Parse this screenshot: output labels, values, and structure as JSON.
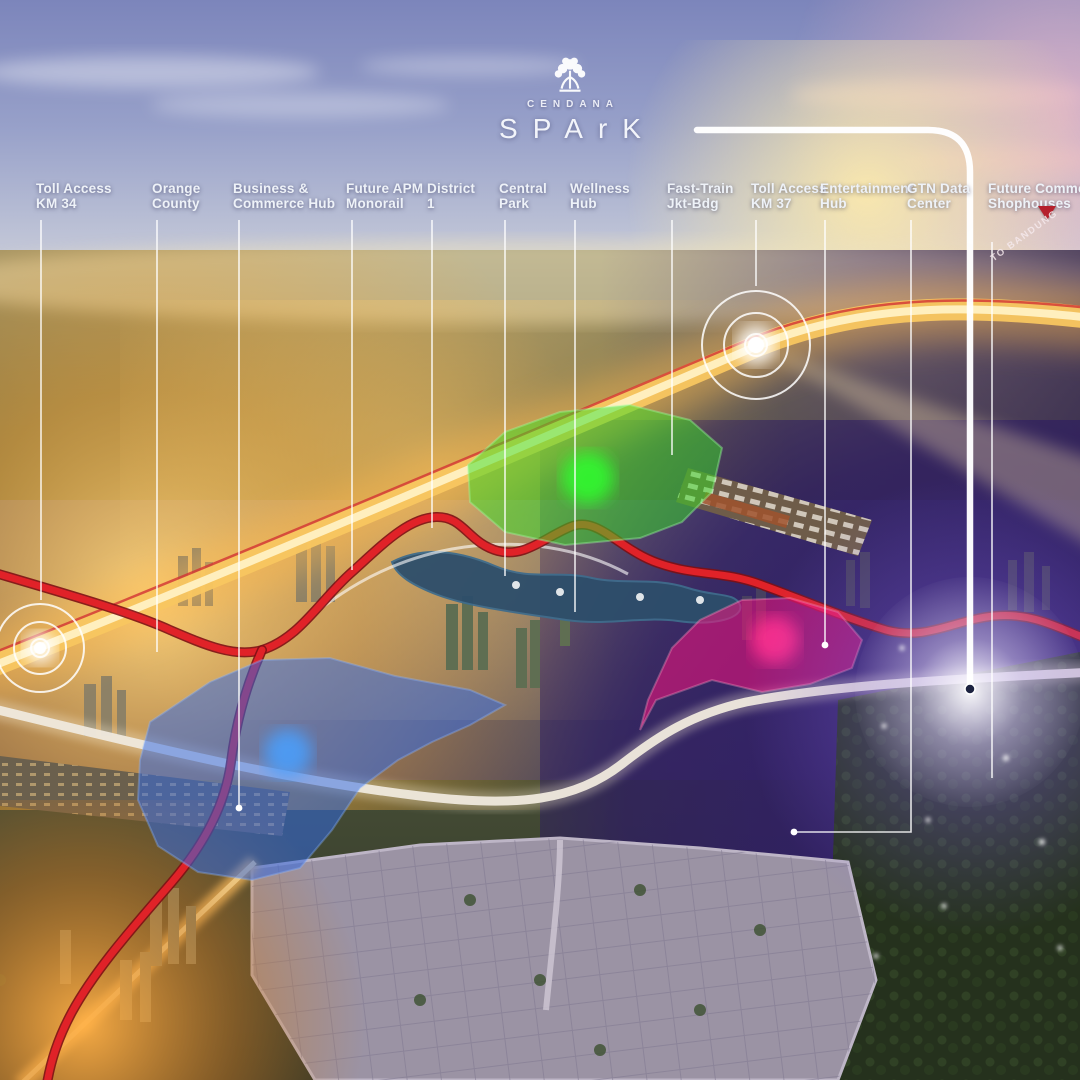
{
  "brand": {
    "name_top": "CENDANA",
    "name_main": "SPArK"
  },
  "annotations": {
    "to_note": "TO BANDUNG",
    "items": [
      {
        "id": "toll-access-km34",
        "line1": "Toll Access",
        "line2": "KM 34",
        "x": 36,
        "lx": 41,
        "to": 600,
        "marker": "target"
      },
      {
        "id": "orange-county",
        "line1": "Orange",
        "line2": "County",
        "x": 152,
        "lx": 157,
        "to": 652,
        "marker": "none"
      },
      {
        "id": "business-commerce",
        "line1": "Business &",
        "line2": "Commerce Hub",
        "x": 233,
        "lx": 239,
        "to": 808,
        "marker": "dot"
      },
      {
        "id": "future-apm-monorail",
        "line1": "Future APM",
        "line2": "Monorail",
        "x": 346,
        "lx": 352,
        "to": 570,
        "marker": "none"
      },
      {
        "id": "district-1",
        "line1": "District",
        "line2": "1",
        "x": 427,
        "lx": 432,
        "to": 528,
        "marker": "none"
      },
      {
        "id": "central-park",
        "line1": "Central",
        "line2": "Park",
        "x": 499,
        "lx": 505,
        "to": 576,
        "marker": "none"
      },
      {
        "id": "wellness-hub",
        "line1": "Wellness",
        "line2": "Hub",
        "x": 570,
        "lx": 575,
        "to": 612,
        "marker": "none"
      },
      {
        "id": "fast-train-jkt-bdg",
        "line1": "Fast-Train",
        "line2": "Jkt-Bdg",
        "x": 667,
        "lx": 672,
        "to": 455,
        "marker": "none"
      },
      {
        "id": "toll-access-km37",
        "line1": "Toll Access",
        "line2": "KM 37",
        "x": 751,
        "lx": 756,
        "to": 286,
        "marker": "target"
      },
      {
        "id": "entertainment-hub",
        "line1": "Entertainment",
        "line2": "Hub",
        "x": 820,
        "lx": 825,
        "to": 645,
        "marker": "dot"
      },
      {
        "id": "gtn-data-center",
        "line1": "GTN Data",
        "line2": "Center",
        "x": 907,
        "lx": 911,
        "to": 832,
        "elbow": 794,
        "marker": "dot"
      },
      {
        "id": "future-commerce-shophouses",
        "line1": "Future Commerce",
        "line2": "Shophouses",
        "x": 988,
        "lx": 992,
        "from": 242,
        "to": 778,
        "marker": "none",
        "arrow": true
      }
    ]
  },
  "zones": [
    {
      "id": "central-park-green-zone",
      "color": "#35e023"
    },
    {
      "id": "business-blue-zone",
      "color": "#2f6ae8"
    },
    {
      "id": "entertainment-pink-zone",
      "color": "#f5127d"
    }
  ],
  "palette": {
    "label_text": "#eef2f8",
    "leader_line": "#ffffff",
    "callout_line": "#ffffff",
    "toll_road": "#e02228",
    "highway_gold": "#f8c660",
    "arrow_red": "#b5202c"
  }
}
